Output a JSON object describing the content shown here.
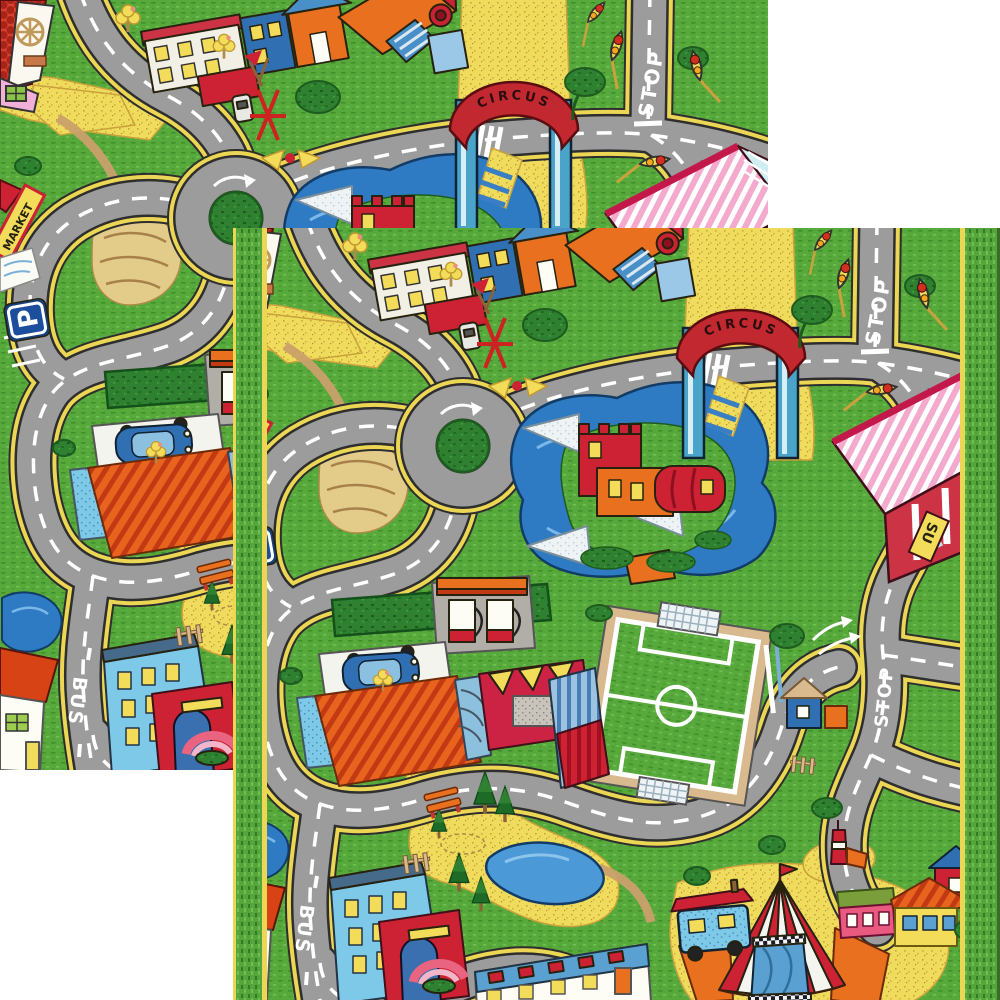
{
  "page": {
    "background": "#ffffff",
    "description_label": "two overlapping city road play rugs"
  },
  "rug_markings": {
    "circus_arch": "CIRCUS",
    "stop_road_marking": "STOP",
    "bus_road_marking": "BUS",
    "market_sign": "MARKET",
    "supermarket_sign": "SU",
    "parking_sign": "P"
  },
  "landmark_icons": [
    "roundabout",
    "circus-gate",
    "castle-island-pond",
    "soccer-field",
    "gas-station",
    "supermarket",
    "circus-tent",
    "apartment-building",
    "parking-area",
    "park-pond",
    "traffic-light",
    "bench",
    "pine-trees"
  ],
  "colors": {
    "grass_green": "#58a93c",
    "road_gray": "#9c9c9c",
    "sand_yellow": "#f0dc5c",
    "border_green": "#55a43c",
    "border_trim_yellow": "#ecd755",
    "pond_blue": "#2e7bc4",
    "roof_red": "#cc2233",
    "roof_orange": "#e8701e",
    "supermarket_pink": "#f4aacc",
    "background_white": "#ffffff"
  }
}
